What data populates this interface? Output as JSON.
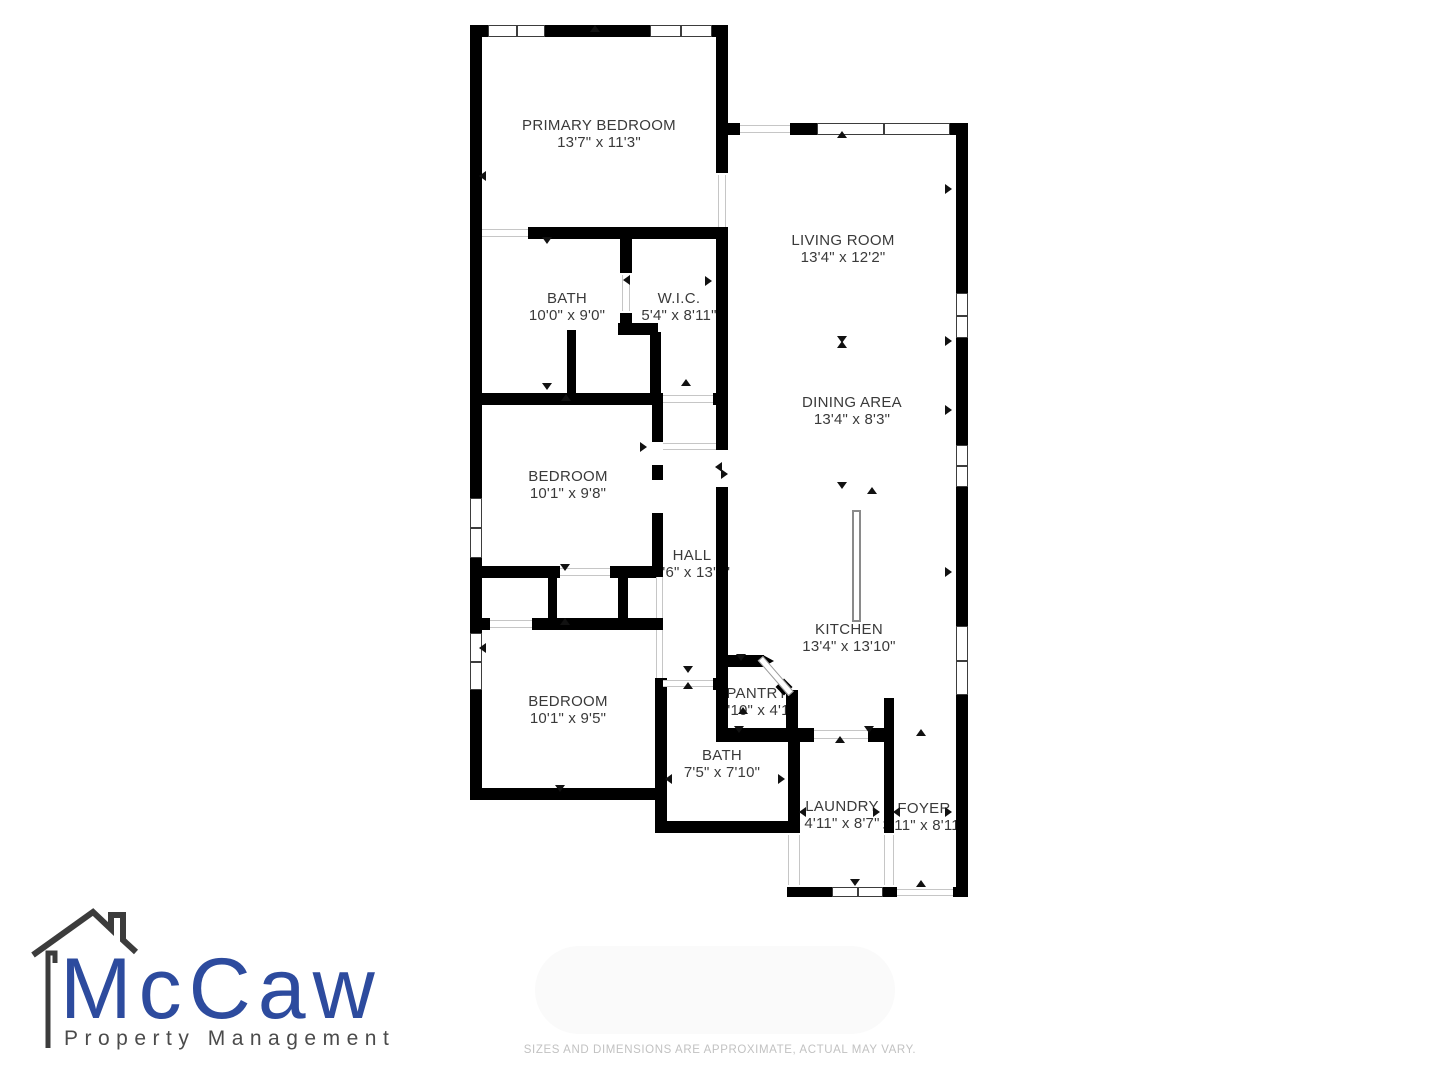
{
  "floor_plan": {
    "wall_color": "#000000",
    "text_color": "#3a3a3a",
    "rooms": [
      {
        "name": "PRIMARY BEDROOM",
        "dims": "13'7\" x 11'3\""
      },
      {
        "name": "LIVING ROOM",
        "dims": "13'4\" x 12'2\""
      },
      {
        "name": "BATH",
        "dims": "10'0\" x 9'0\""
      },
      {
        "name": "W.I.C.",
        "dims": "5'4\" x 8'11\""
      },
      {
        "name": "DINING AREA",
        "dims": "13'4\" x 8'3\""
      },
      {
        "name": "BEDROOM",
        "dims": "10'1\" x 9'8\""
      },
      {
        "name": "HALL",
        "dims": "3'6\" x 13'2\""
      },
      {
        "name": "KITCHEN",
        "dims": "13'4\" x 13'10\""
      },
      {
        "name": "BEDROOM",
        "dims": "10'1\" x 9'5\""
      },
      {
        "name": "PANTRY",
        "dims": "3'10\" x 4'1\""
      },
      {
        "name": "BATH",
        "dims": "7'5\" x 7'10\""
      },
      {
        "name": "LAUNDRY",
        "dims": "4'11\" x 8'7\""
      },
      {
        "name": "FOYER",
        "dims": "3'11\" x 8'11\""
      }
    ]
  },
  "logo": {
    "brand": "McCaw",
    "tagline": "Property Management",
    "brand_color": "#2d4b9e",
    "tagline_color": "#4b4b4b",
    "house_color": "#3c3c3c"
  },
  "footer": {
    "disclaimer": "SIZES AND DIMENSIONS ARE APPROXIMATE, ACTUAL MAY VARY.",
    "disclaimer_color": "#c2c2c2"
  }
}
